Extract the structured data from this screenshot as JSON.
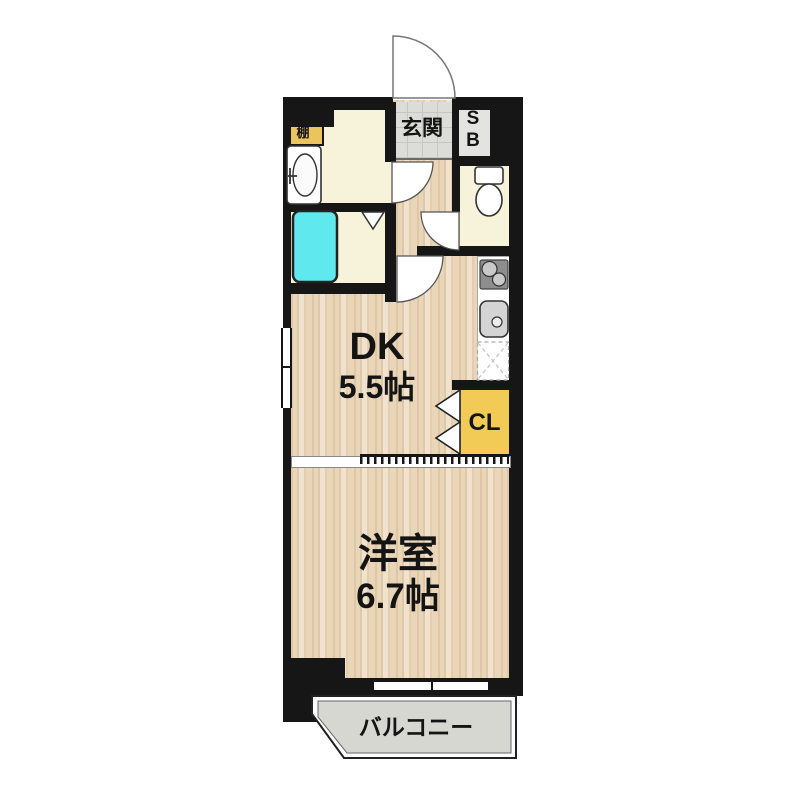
{
  "title": "1DK apartment floor plan",
  "labels": {
    "entrance": "玄関",
    "shoe_box": {
      "line1": "S",
      "line2": "B"
    },
    "shelf": "棚",
    "dk": {
      "name": "DK",
      "size": "5.5帖"
    },
    "closet": "CL",
    "western_room": {
      "name": "洋室",
      "size": "6.7帖"
    },
    "balcony": "バルコニー"
  },
  "colors": {
    "wall_black": "#161616",
    "wood_floor": "#e9d5b8",
    "room_cream": "#f6f3da",
    "bathtub_cyan": "#5fe8ee",
    "closet_yellow": "#f1cb55",
    "shelf_yellow": "#e9c45f",
    "entrance_tile_gray": "#dcdcd8",
    "shoe_box_gray": "#e3e3e1",
    "balcony_gray": "#d7d7d1",
    "stove_gray": "#8d8d8d"
  }
}
